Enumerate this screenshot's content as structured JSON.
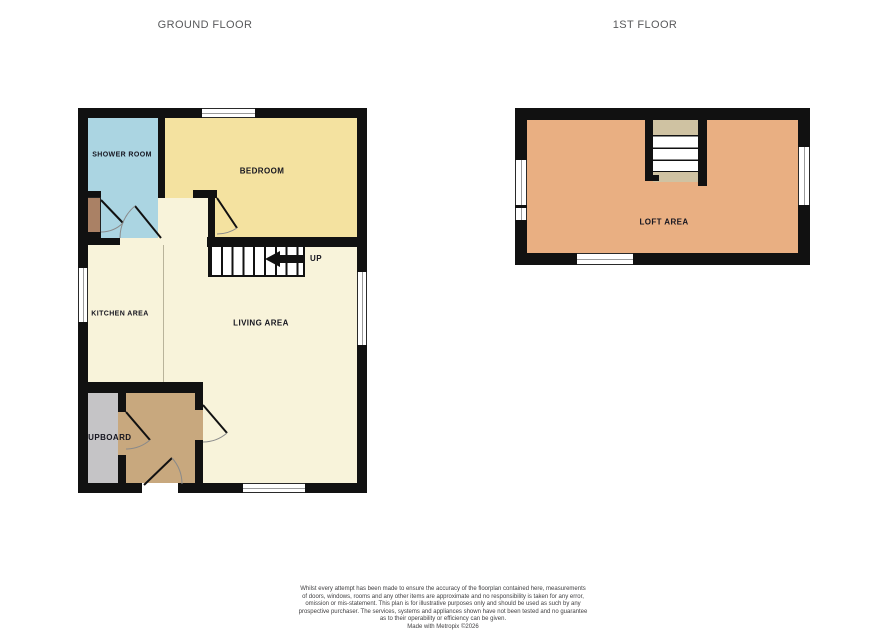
{
  "floorplan": {
    "ground": {
      "title": "GROUND FLOOR",
      "rooms": {
        "shower": "SHOWER ROOM",
        "bedroom": "BEDROOM",
        "kitchen": "KITCHEN AREA",
        "living": "LIVING AREA",
        "cupboard": "CUPBOARD"
      },
      "stairs": {
        "direction_label": "UP",
        "arrow_icon": "left-arrow-icon"
      }
    },
    "first": {
      "title": "1ST FLOOR",
      "rooms": {
        "loft": "LOFT AREA"
      }
    },
    "colors": {
      "wall": "#111111",
      "shower_room_fill": "#abd5e2",
      "bedroom_fill": "#f4e2a0",
      "kitchen_living_fill": "#f8f3da",
      "hall_fill": "#c8a87e",
      "cupboard_fill": "#c5c4c6",
      "back_door_fill": "#aa8165",
      "loft_fill": "#e9af82",
      "stair_landing_fill": "#cfc2a2",
      "window_fill": "#ffffff",
      "title_text": "#58595b",
      "room_label_text": "#15151f",
      "disclaimer_text": "#414042"
    }
  },
  "footer": {
    "disclaimer_lines": [
      "Whilst every attempt has been made to ensure the accuracy of the floorplan contained here, measurements",
      "of doors, windows, rooms and any other items are approximate and no responsibility is taken for any error,",
      "omission or mis-statement. This plan is for illustrative purposes only and should be used as such by any",
      "prospective purchaser. The services, systems and appliances shown have not been tested and no guarantee",
      "as to their operability or efficiency can be given."
    ],
    "credit": "Made with Metropix ©2026"
  }
}
